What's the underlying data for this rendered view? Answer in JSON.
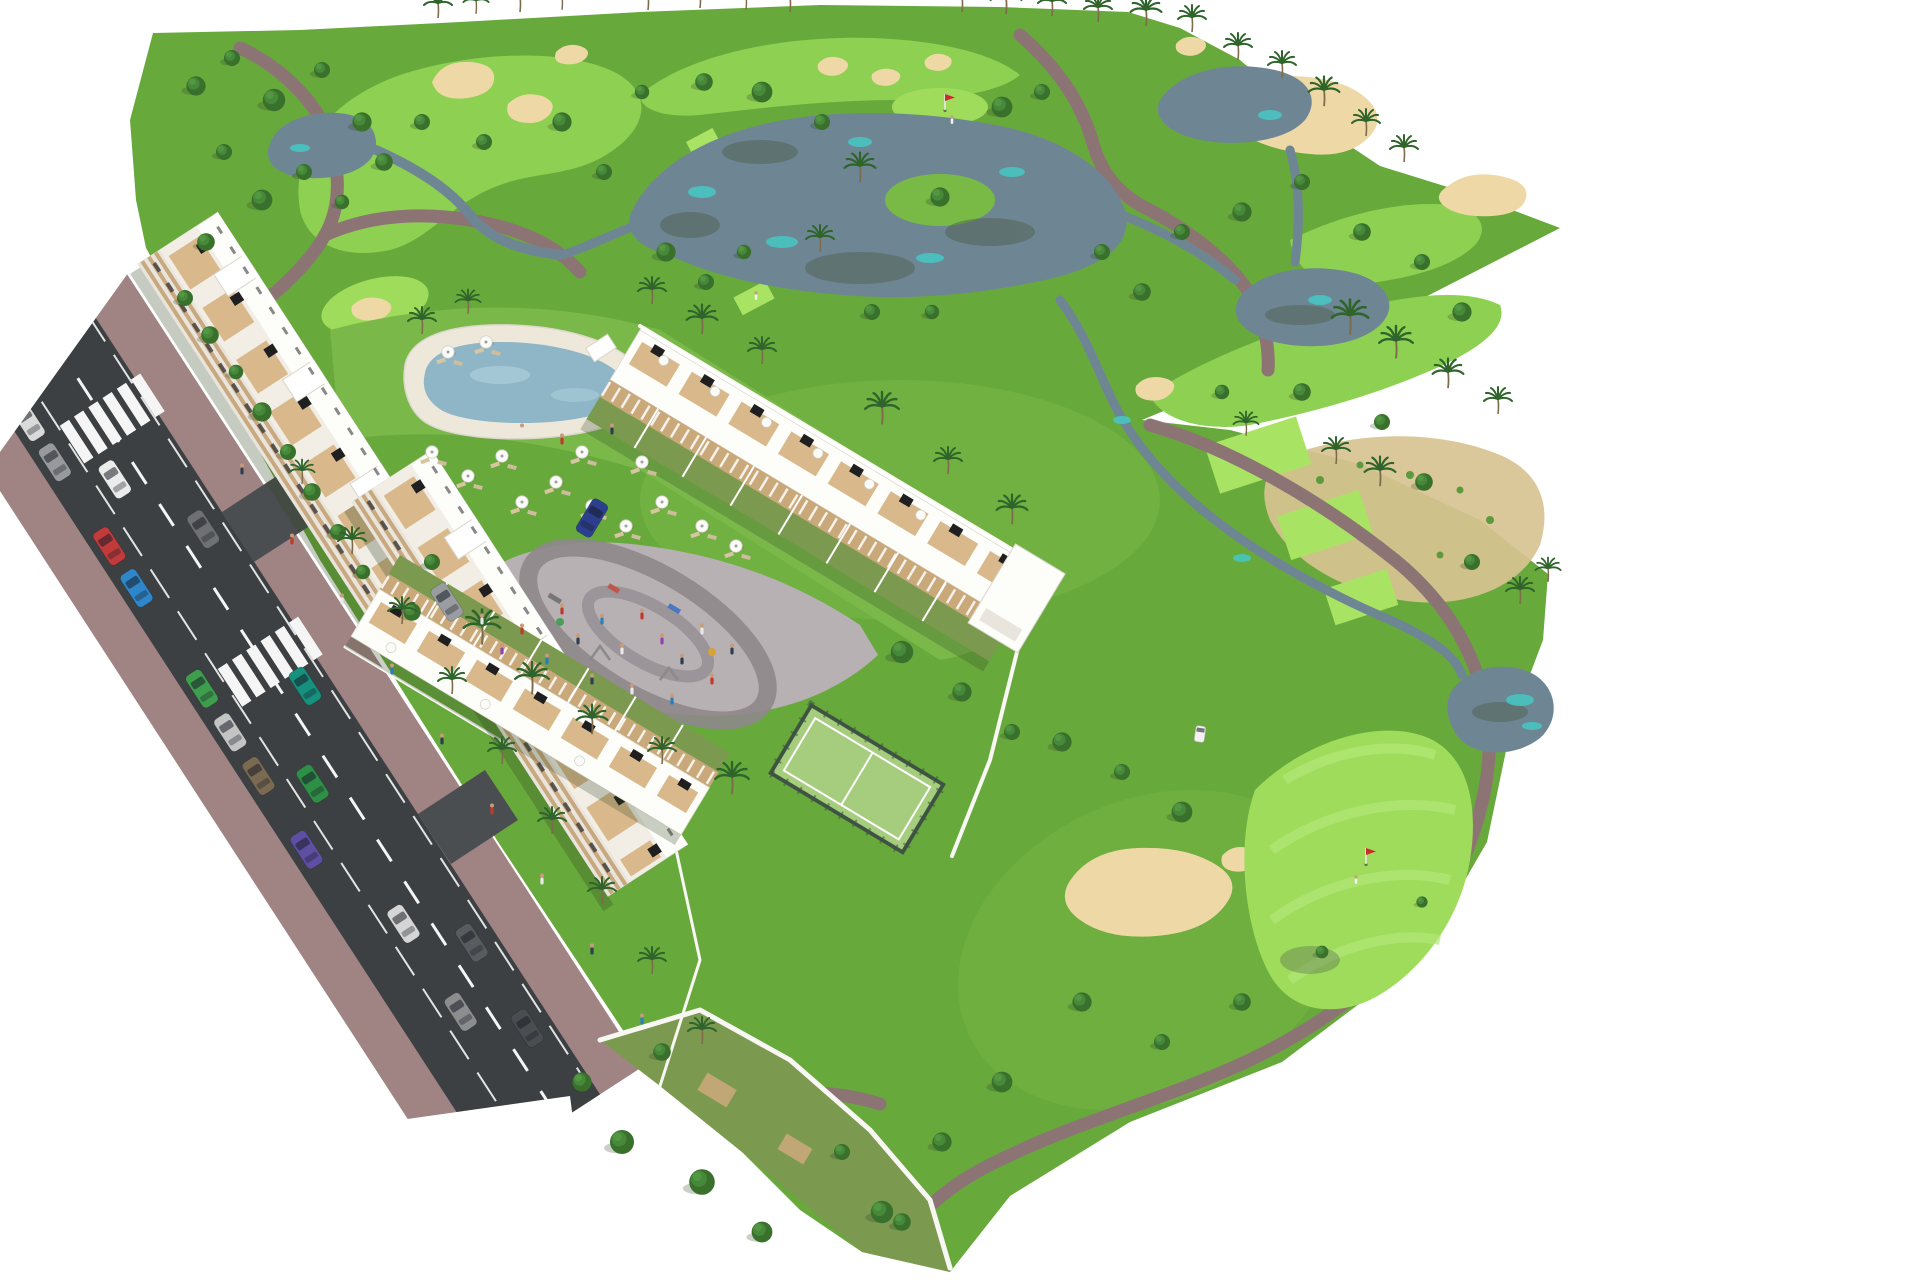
{
  "meta": {
    "title": "Aerial 3D architectural rendering - golf resort apartment development",
    "description": "Bird's-eye computer rendering of a white Mediterranean apartment complex beside a golf course with lakes, sand bunkers, palm trees, pool, padel court, playground and a bordering street with parked cars."
  },
  "palette": {
    "bg": "#ffffff",
    "grass": "#68a93c",
    "grass2": "#79ba46",
    "fairway": "#8ed052",
    "fairwayLight": "#9bdb5e",
    "tee": "#a9e364",
    "green": "#a0dc5c",
    "greenLight": "#b2e878",
    "lawn": "#7ab84a",
    "oliveGrass": "#7b9a4f",
    "lake": "#6e8694",
    "lakeTeal": "#45c8c4",
    "lakeDark": "#50604f",
    "sand": "#eed9a6",
    "scrub": "#d8c391",
    "path": "#8d7474",
    "road": "#3c4043",
    "roadLight": "#4b4e51",
    "sidewalk": "#a08484",
    "marking": "#f5f5f5",
    "wallWhite": "#f8f7f3",
    "bldgWhite": "#fdfdfa",
    "bldgShade": "#e9e5dc",
    "bldgCream": "#f2eee6",
    "band": "#c8a87e",
    "window": "#3c3c3c",
    "panel": "#1f1f1f",
    "wood": "#d9b98c",
    "pergola": "#c9a87a",
    "poolDeck": "#eee8db",
    "poolWater": "#8fb6c6",
    "poolLight": "#a9ccd9",
    "court": "#a5cd7d",
    "courtFence": "#3e5344",
    "pavement": "#b7b1b4",
    "pavementRing": "#8e888b",
    "treeDark": "#38702c",
    "treeMid": "#47893a",
    "treeLight": "#569a45",
    "palm": "#2f652b",
    "trunk": "#7d6b4c",
    "shadow": "#2e4420",
    "cart": "#f2f2f2"
  },
  "scene": {
    "trees": [
      [
        185,
        298,
        1
      ],
      [
        210,
        335,
        1.1
      ],
      [
        236,
        372,
        0.9
      ],
      [
        262,
        412,
        1.2
      ],
      [
        288,
        452,
        1
      ],
      [
        312,
        492,
        1.1
      ],
      [
        338,
        532,
        1
      ],
      [
        363,
        572,
        0.9
      ],
      [
        196,
        86,
        1.2
      ],
      [
        232,
        58,
        1
      ],
      [
        274,
        100,
        1.4
      ],
      [
        322,
        70,
        1
      ],
      [
        362,
        122,
        1.2
      ],
      [
        224,
        152,
        1
      ],
      [
        262,
        200,
        1.3
      ],
      [
        304,
        172,
        1
      ],
      [
        206,
        242,
        1.1
      ],
      [
        342,
        202,
        0.9
      ],
      [
        384,
        162,
        1.1
      ],
      [
        422,
        122,
        1
      ],
      [
        484,
        142,
        1
      ],
      [
        562,
        122,
        1.2
      ],
      [
        604,
        172,
        1
      ],
      [
        642,
        92,
        0.9
      ],
      [
        704,
        82,
        1.1
      ],
      [
        762,
        92,
        1.3
      ],
      [
        822,
        122,
        1
      ],
      [
        666,
        252,
        1.2
      ],
      [
        706,
        282,
        1
      ],
      [
        744,
        252,
        0.9
      ],
      [
        1002,
        107,
        1.3
      ],
      [
        1042,
        92,
        1
      ],
      [
        940,
        197,
        1.2
      ],
      [
        1102,
        252,
        1
      ],
      [
        1142,
        292,
        1.1
      ],
      [
        872,
        312,
        1
      ],
      [
        932,
        312,
        0.9
      ],
      [
        1182,
        232,
        1
      ],
      [
        1242,
        212,
        1.2
      ],
      [
        1302,
        182,
        1
      ],
      [
        1362,
        232,
        1.1
      ],
      [
        1422,
        262,
        1
      ],
      [
        1462,
        312,
        1.2
      ],
      [
        1382,
        422,
        1
      ],
      [
        1302,
        392,
        1.1
      ],
      [
        1222,
        392,
        0.9
      ],
      [
        1424,
        482,
        1.1
      ],
      [
        1472,
        562,
        1
      ],
      [
        1062,
        742,
        1.2
      ],
      [
        1122,
        772,
        1
      ],
      [
        1182,
        812,
        1.3
      ],
      [
        1082,
        1002,
        1.2
      ],
      [
        1162,
        1042,
        1
      ],
      [
        1242,
        1002,
        1.1
      ],
      [
        1002,
        1082,
        1.3
      ],
      [
        942,
        1142,
        1.2
      ],
      [
        882,
        1212,
        1.4
      ],
      [
        1322,
        952,
        0.8
      ],
      [
        1422,
        902,
        0.7
      ],
      [
        622,
        1142,
        1.5
      ],
      [
        702,
        1182,
        1.6
      ],
      [
        762,
        1232,
        1.3
      ],
      [
        582,
        1082,
        1.2
      ],
      [
        662,
        1052,
        1.1
      ],
      [
        842,
        1152,
        1
      ],
      [
        902,
        1222,
        1.1
      ],
      [
        902,
        652,
        1.4
      ],
      [
        962,
        692,
        1.2
      ],
      [
        1012,
        732,
        1
      ],
      [
        432,
        562,
        1
      ],
      [
        412,
        612,
        1.1
      ]
    ],
    "palms": [
      [
        438,
        16,
        1
      ],
      [
        476,
        12,
        0.9
      ],
      [
        520,
        10,
        1
      ],
      [
        562,
        8,
        0.9
      ],
      [
        648,
        8,
        1
      ],
      [
        700,
        6,
        1
      ],
      [
        746,
        8,
        0.9
      ],
      [
        790,
        10,
        1
      ],
      [
        962,
        10,
        1
      ],
      [
        1006,
        12,
        1.1
      ],
      [
        1052,
        14,
        1
      ],
      [
        1098,
        20,
        1
      ],
      [
        1146,
        24,
        1.1
      ],
      [
        1192,
        30,
        1
      ],
      [
        1238,
        58,
        1
      ],
      [
        1282,
        76,
        1
      ],
      [
        1324,
        104,
        1.1
      ],
      [
        1366,
        134,
        1
      ],
      [
        1404,
        160,
        1
      ],
      [
        860,
        180,
        1.1
      ],
      [
        820,
        250,
        1
      ],
      [
        1350,
        332,
        1.3
      ],
      [
        1396,
        356,
        1.2
      ],
      [
        1448,
        386,
        1.1
      ],
      [
        1498,
        412,
        1
      ],
      [
        1246,
        434,
        0.9
      ],
      [
        1336,
        462,
        1
      ],
      [
        1380,
        484,
        1.1
      ],
      [
        1520,
        602,
        1
      ],
      [
        1548,
        580,
        0.9
      ],
      [
        422,
        332,
        1
      ],
      [
        468,
        312,
        0.9
      ],
      [
        652,
        302,
        1
      ],
      [
        702,
        332,
        1.1
      ],
      [
        762,
        362,
        1
      ],
      [
        882,
        422,
        1.2
      ],
      [
        948,
        472,
        1
      ],
      [
        1012,
        522,
        1.1
      ],
      [
        482,
        642,
        1.3
      ],
      [
        532,
        692,
        1.2
      ],
      [
        592,
        732,
        1.1
      ],
      [
        662,
        762,
        1
      ],
      [
        732,
        792,
        1.2
      ],
      [
        302,
        482,
        0.9
      ],
      [
        352,
        552,
        1
      ],
      [
        402,
        622,
        1
      ],
      [
        452,
        692,
        1
      ],
      [
        502,
        762,
        1
      ],
      [
        552,
        832,
        1
      ],
      [
        602,
        902,
        1
      ],
      [
        652,
        972,
        1
      ],
      [
        702,
        1042,
        1
      ]
    ],
    "umbrellas": [
      [
        448,
        352
      ],
      [
        486,
        342
      ],
      [
        432,
        452
      ],
      [
        468,
        476
      ],
      [
        502,
        456
      ],
      [
        522,
        502
      ],
      [
        556,
        482
      ],
      [
        592,
        506
      ],
      [
        626,
        526
      ],
      [
        662,
        502
      ],
      [
        702,
        526
      ],
      [
        736,
        546
      ],
      [
        642,
        462
      ],
      [
        582,
        452
      ]
    ],
    "people": [
      [
        562,
        612,
        "#c0392b"
      ],
      [
        578,
        642,
        "#2c3e50"
      ],
      [
        602,
        622,
        "#2980b9"
      ],
      [
        622,
        652,
        "#e8e8e8"
      ],
      [
        642,
        617,
        "#c0392b"
      ],
      [
        662,
        642,
        "#8e44ad"
      ],
      [
        682,
        662,
        "#2c3e50"
      ],
      [
        702,
        632,
        "#e8e8e8"
      ],
      [
        547,
        662,
        "#2980b9"
      ],
      [
        522,
        632,
        "#c0392b"
      ],
      [
        592,
        682,
        "#2c3e50"
      ],
      [
        632,
        692,
        "#e8e8e8"
      ],
      [
        672,
        702,
        "#2980b9"
      ],
      [
        712,
        682,
        "#c0392b"
      ],
      [
        732,
        652,
        "#2c3e50"
      ],
      [
        482,
        622,
        "#e8e8e8"
      ],
      [
        502,
        652,
        "#8e44ad"
      ],
      [
        242,
        472,
        "#2c3e50"
      ],
      [
        292,
        542,
        "#c0392b"
      ],
      [
        342,
        602,
        "#e8e8e8"
      ],
      [
        392,
        672,
        "#2980b9"
      ],
      [
        442,
        742,
        "#2c3e50"
      ],
      [
        492,
        812,
        "#c0392b"
      ],
      [
        542,
        882,
        "#e8e8e8"
      ],
      [
        592,
        952,
        "#2c3e50"
      ],
      [
        642,
        1022,
        "#2980b9"
      ],
      [
        522,
        432,
        "#e8e8e8"
      ],
      [
        562,
        442,
        "#c0392b"
      ],
      [
        612,
        432,
        "#2c3e50"
      ]
    ],
    "road_cars": [
      [
        62,
        58,
        "#e5e5e5"
      ],
      [
        62,
        104,
        "#3a66c9"
      ],
      [
        62,
        150,
        "#dadada"
      ],
      [
        62,
        198,
        "#97999c"
      ],
      [
        62,
        298,
        "#c23b3b"
      ],
      [
        62,
        348,
        "#2f86c9"
      ],
      [
        62,
        468,
        "#3f9e4d"
      ],
      [
        62,
        520,
        "#c4c4c4"
      ],
      [
        62,
        572,
        "#7a6a52"
      ],
      [
        62,
        660,
        "#5e4fa2"
      ],
      [
        103,
        245,
        "#ececec"
      ],
      [
        103,
        608,
        "#2e8f46"
      ],
      [
        103,
        775,
        "#d5d5d5"
      ],
      [
        103,
        880,
        "#8b8d8f"
      ],
      [
        150,
        335,
        "#6e7072"
      ],
      [
        150,
        522,
        "#16917e"
      ],
      [
        150,
        828,
        "#595c5e"
      ],
      [
        150,
        930,
        "#4b4e50"
      ]
    ],
    "site_cars": [
      [
        592,
        518,
        31,
        "#2b3f8e"
      ],
      [
        447,
        602,
        -33,
        "#9a9da0"
      ]
    ],
    "golf_cart": [
      1200,
      734
    ],
    "flags": [
      [
        945,
        110
      ],
      [
        1366,
        864
      ]
    ],
    "golfers": [
      [
        952,
        122
      ],
      [
        756,
        298
      ],
      [
        1356,
        882
      ]
    ]
  }
}
